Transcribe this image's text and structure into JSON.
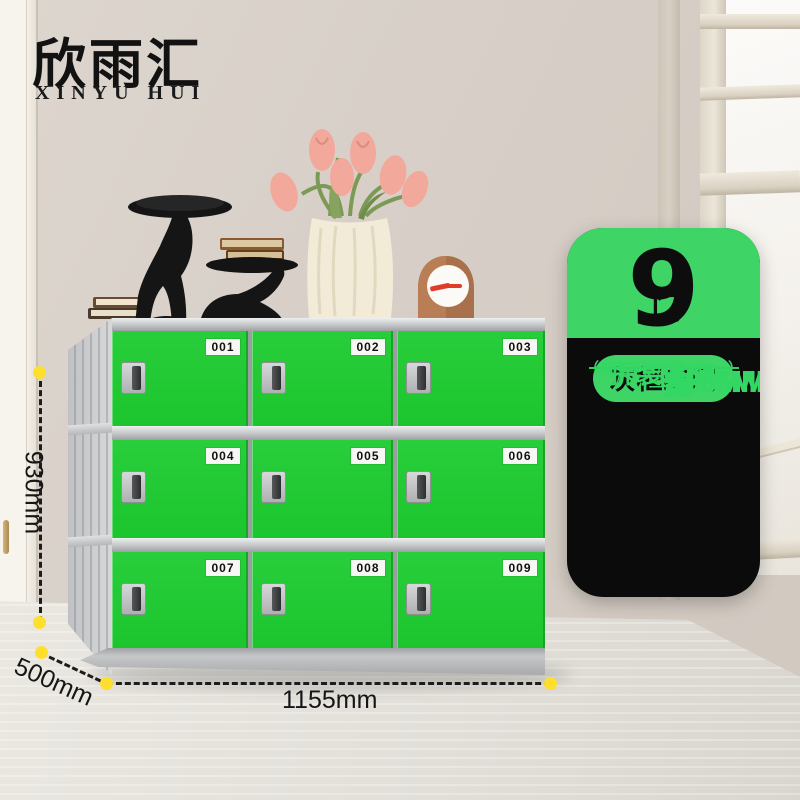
{
  "brand": {
    "logo_cn": "欣雨汇",
    "logo_en": "XINYU HUI"
  },
  "locker": {
    "door_numbers": [
      "001",
      "002",
      "003",
      "004",
      "005",
      "006",
      "007",
      "008",
      "009"
    ],
    "door_color": "#1fc934",
    "frame_color": "#c6c8ca"
  },
  "dimensions": {
    "height_label": "930mm",
    "depth_label": "500mm",
    "width_label": "1155mm",
    "marker_color": "#ffdf2e"
  },
  "info_card": {
    "doors_count": "9",
    "doors_unit": "门",
    "variant_pill": "灰框绿门",
    "specs": [
      {
        "label": "高",
        "value": "930MM"
      },
      {
        "label": "宽",
        "value": "1155MM"
      },
      {
        "label": "深",
        "value": "500MM"
      }
    ],
    "shipping_note": "拆装发货",
    "shipping_subnote": "（高度不含底座60mm）",
    "green": "#3ed466",
    "black": "#0b0b0b",
    "text_green": "#33d763"
  }
}
